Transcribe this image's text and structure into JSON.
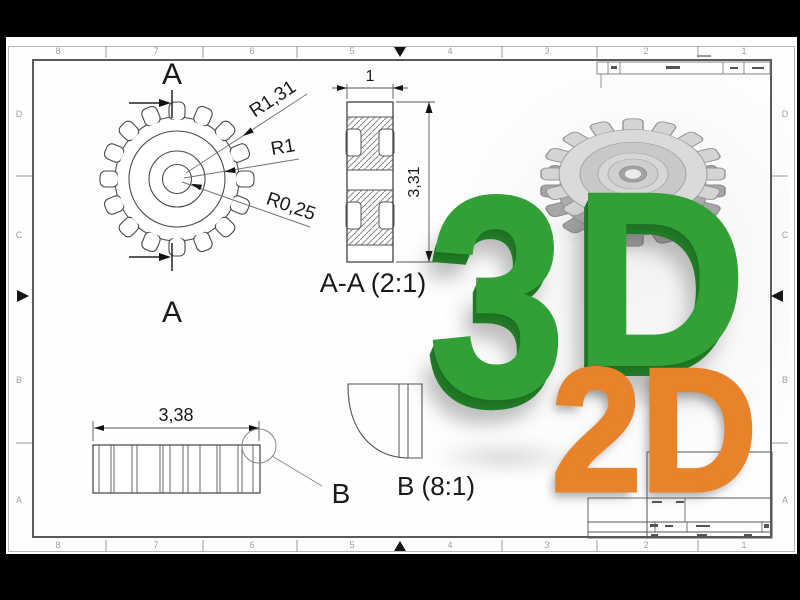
{
  "rulers": {
    "cols": [
      "8",
      "7",
      "6",
      "5",
      "4",
      "3",
      "2",
      "1"
    ],
    "rows": [
      "D",
      "C",
      "B",
      "A"
    ]
  },
  "gear_view": {
    "section_label": "A",
    "r_outer": "R1,31",
    "r_mid": "R1",
    "r_bore": "R0,25"
  },
  "section_view": {
    "dim_width": "1",
    "dim_height": "3,31",
    "caption": "A-A (2:1)"
  },
  "side_view": {
    "dim_width": "3,38",
    "detail_letter": "B"
  },
  "detail_view": {
    "caption": "B (8:1)"
  },
  "overlay": {
    "label_3d": "3D",
    "label_2d": "2D",
    "green": "#32a036",
    "orange": "#e8822b"
  }
}
